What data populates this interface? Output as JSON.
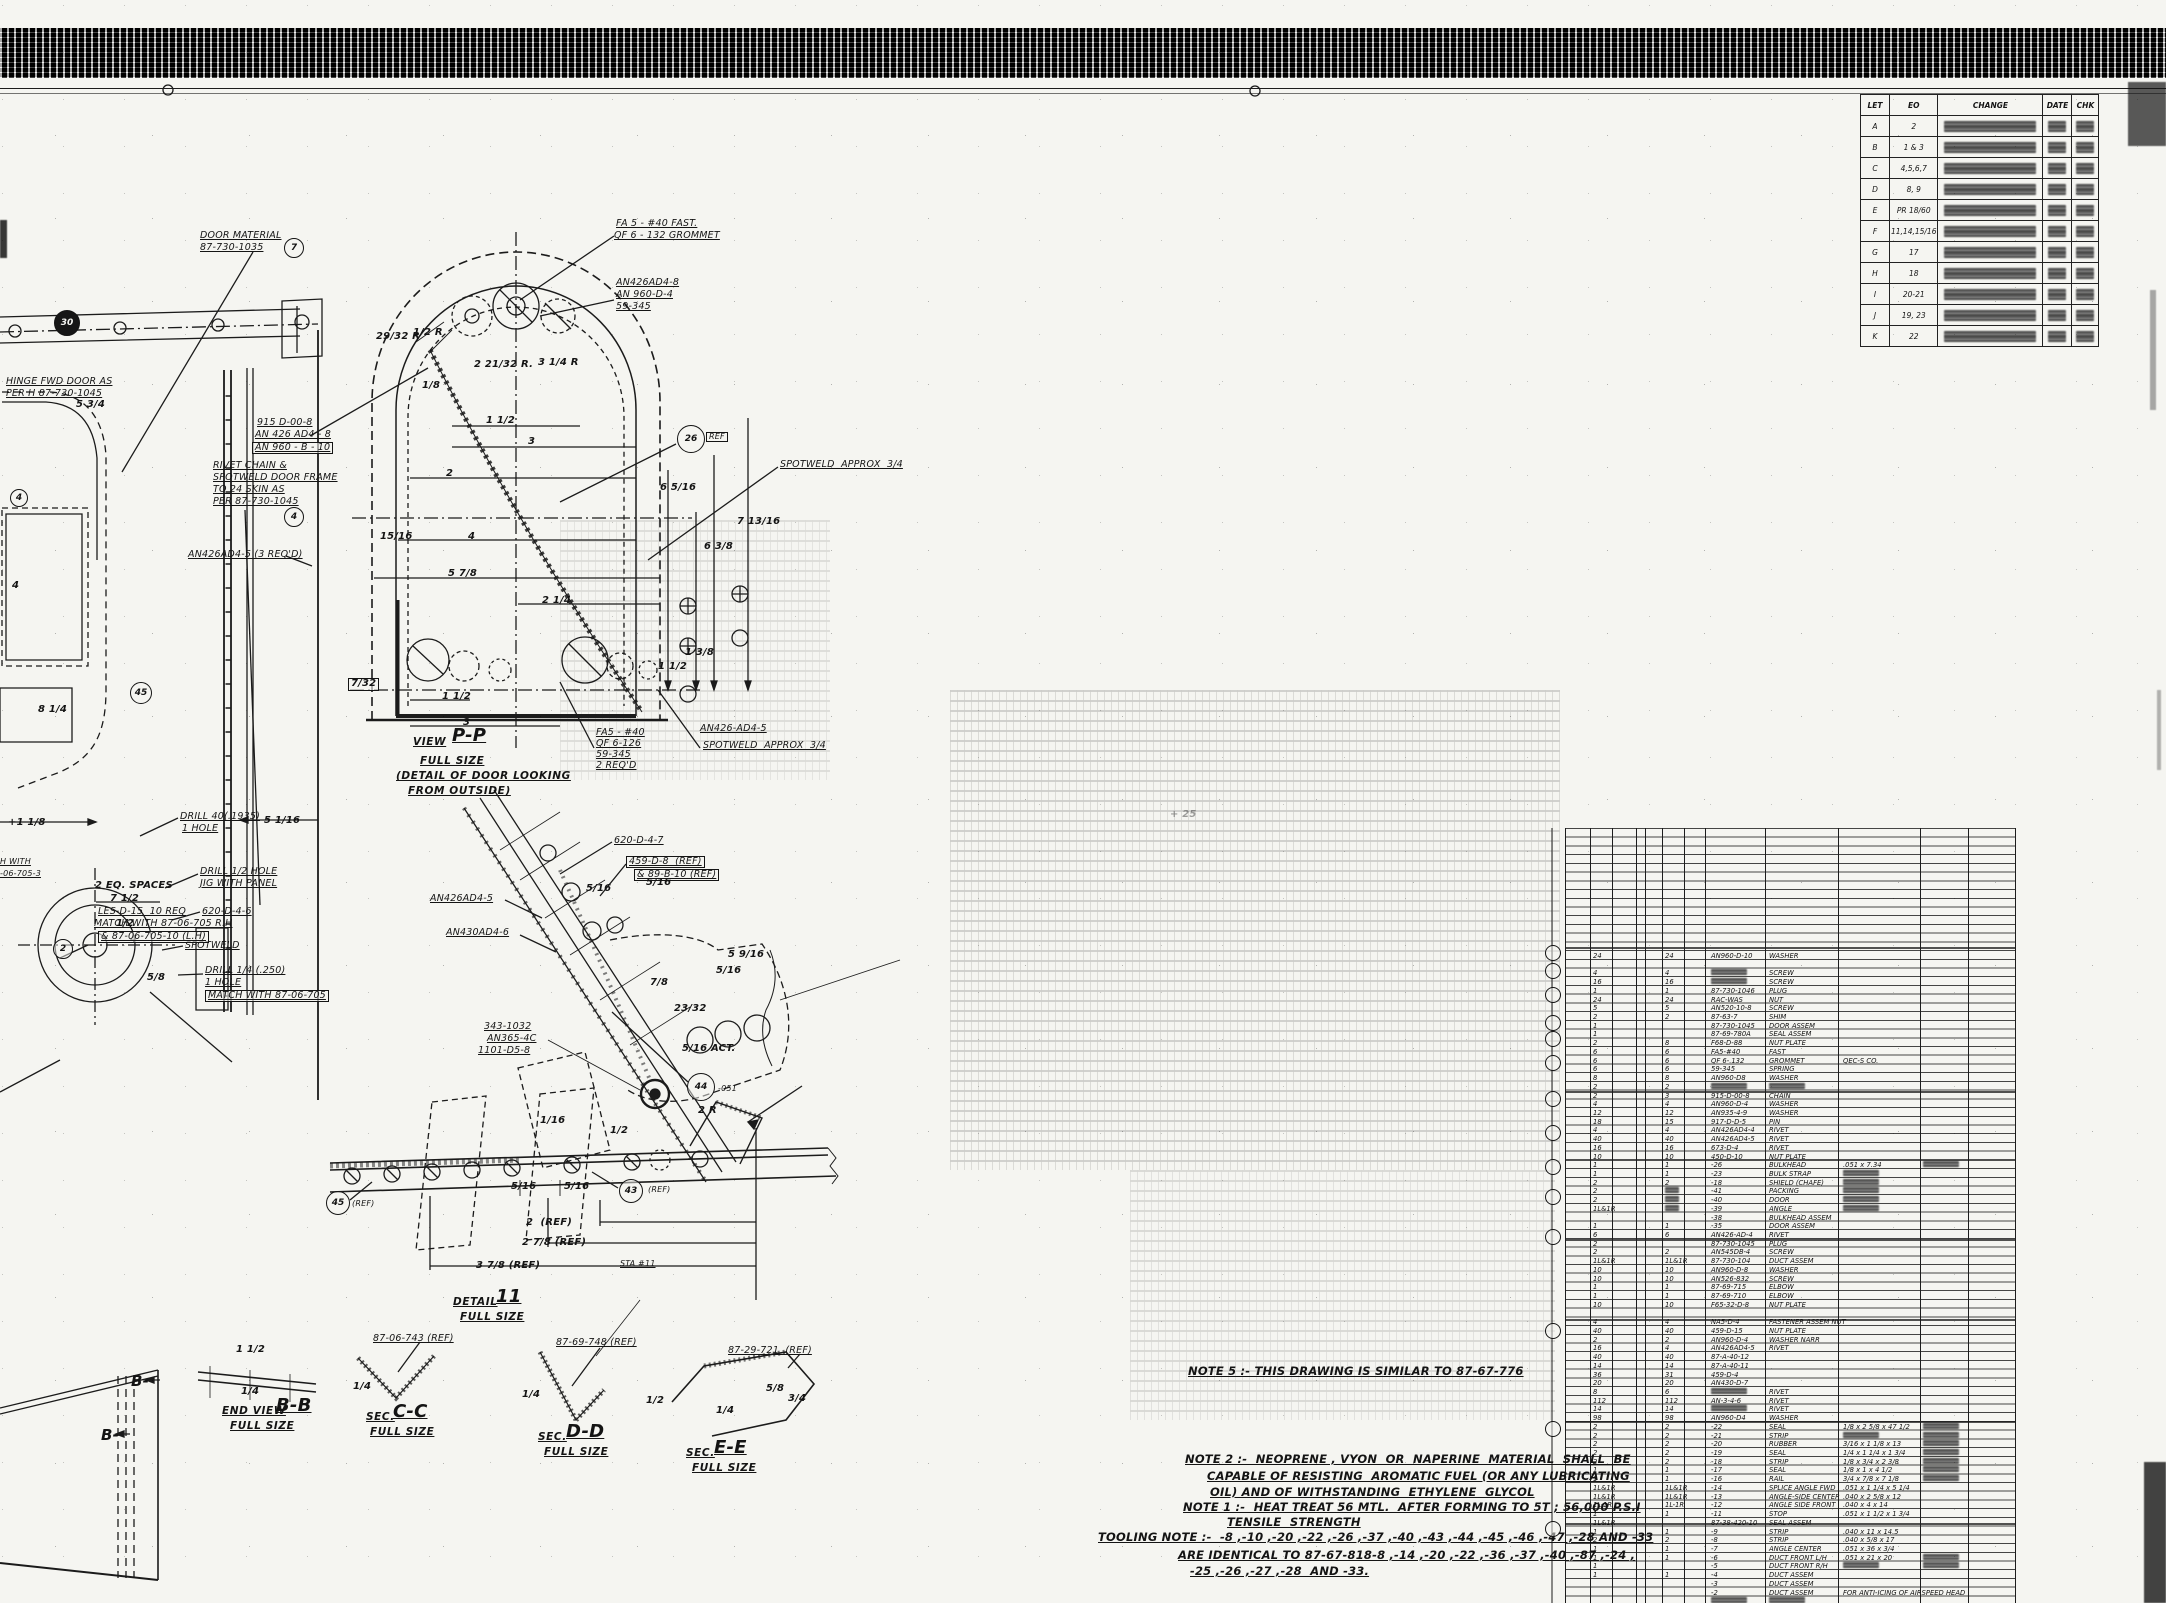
{
  "sheet": {
    "kind": "scanned engineering drawing"
  },
  "revision": {
    "headers": [
      "LET",
      "EO",
      "CHANGE",
      "DATE",
      "CHK"
    ],
    "rows": [
      {
        "let": "A",
        "eo": "2"
      },
      {
        "let": "B",
        "eo": "1 & 3"
      },
      {
        "let": "C",
        "eo": "4,5,6,7"
      },
      {
        "let": "D",
        "eo": "8, 9"
      },
      {
        "let": "E",
        "eo": "PR 18/60"
      },
      {
        "let": "F",
        "eo": "11,14,15/16"
      },
      {
        "let": "G",
        "eo": "17"
      },
      {
        "let": "H",
        "eo": "18"
      },
      {
        "let": "I",
        "eo": "20-21"
      },
      {
        "let": "J",
        "eo": "19, 23"
      },
      {
        "let": "K",
        "eo": "22"
      }
    ]
  },
  "notes": {
    "note5": "NOTE 5 :- THIS DRAWING IS SIMILAR TO 87-67-776",
    "note2_l1": "NOTE 2 :-  NEOPRENE , VYON  OR  NAPERINE  MATERIAL  SHALL  BE",
    "note2_l2": "CAPABLE OF RESISTING  AROMATIC FUEL (OR ANY LUBRICATING",
    "note2_l3": "OIL) AND OF WITHSTANDING  ETHYLENE  GLYCOL",
    "note1_l1": "NOTE 1 :-  HEAT TREAT 56 MTL.  AFTER FORMING TO 5T ; 56,000 P.S.I",
    "note1_l2": "TENSILE  STRENGTH",
    "tooling_l1": "TOOLING NOTE :-  -8 ,-10 ,-20 ,-22 ,-26 ,-37 ,-40 ,-43 ,-44 ,-45 ,-46 ,-47 ,-28 AND -33",
    "tooling_l2": "ARE IDENTICAL TO 87-67-818-8 ,-14 ,-20 ,-22 ,-36 ,-37 ,-40 ,-87 ,-24 ,",
    "tooling_l3": "-25 ,-26 ,-27 ,-28  AND -33."
  },
  "annotations": [
    [
      200,
      231,
      "DOOR MATERIAL",
      "u"
    ],
    [
      200,
      243,
      "87-730-1035",
      "u"
    ],
    [
      6,
      377,
      "HINGE FWD DOOR AS",
      "u"
    ],
    [
      6,
      389,
      "PER H 87-730-1045",
      "u"
    ],
    [
      257,
      418,
      "915 D-00-8",
      "u"
    ],
    [
      255,
      430,
      "AN 426 AD4 - 8",
      "u"
    ],
    [
      252,
      442,
      "AN 960 - B - 10",
      "u box"
    ],
    [
      213,
      461,
      "RIVET CHAIN &",
      "u"
    ],
    [
      213,
      473,
      "SPOTWELD DOOR FRAME",
      "u"
    ],
    [
      213,
      485,
      "TO 24 SKIN AS",
      "u"
    ],
    [
      213,
      497,
      "PER 87-730-1045",
      "u"
    ],
    [
      188,
      550,
      "AN426AD4-5 (3 REQ'D)",
      "u"
    ],
    [
      76,
      400,
      "5 3/4",
      "d"
    ],
    [
      12,
      581,
      "4",
      "d"
    ],
    [
      38,
      705,
      "8 1/4",
      "d"
    ],
    [
      8,
      818,
      "+1 1/8",
      "d"
    ],
    [
      264,
      816,
      "5 1/16",
      "d"
    ],
    [
      116,
      919,
      "1/2",
      "d"
    ],
    [
      130,
      935,
      "4",
      "d"
    ],
    [
      147,
      973,
      "5/8",
      "d"
    ],
    [
      180,
      812,
      "DRILL 40(.1935)",
      "u"
    ],
    [
      182,
      824,
      "1 HOLE",
      "u"
    ],
    [
      200,
      867,
      "DRILL 1/2 HOLE",
      "u"
    ],
    [
      200,
      879,
      "JIG WITH PANEL",
      "u"
    ],
    [
      202,
      907,
      "620-D-4-6",
      "u"
    ],
    [
      185,
      941,
      "SPOTWELD",
      "u"
    ],
    [
      205,
      966,
      "DRILL 1/4 (.250)",
      "u"
    ],
    [
      205,
      978,
      "1 HOLE",
      "u"
    ],
    [
      205,
      990,
      "MATCH WITH 87-06-705",
      "u box"
    ],
    [
      95,
      881,
      "2 EQ. SPACES",
      "d"
    ],
    [
      110,
      894,
      "7 1/2",
      "d"
    ],
    [
      98,
      907,
      "LES-D-15  10 REQ",
      "u"
    ],
    [
      94,
      919,
      "MATCH WITH 87-06-705 R.H",
      "u"
    ],
    [
      98,
      931,
      "& 87-06-705-10 (L.H)",
      "u box"
    ],
    [
      0,
      858,
      "H WITH",
      "s u"
    ],
    [
      0,
      870,
      "-06-705-3",
      "s u"
    ],
    [
      616,
      219,
      "FA 5 - #40 FAST.",
      "u"
    ],
    [
      614,
      231,
      "QF 6 - 132 GROMMET",
      "u"
    ],
    [
      616,
      278,
      "AN426AD4-8",
      "u"
    ],
    [
      616,
      290,
      "AN 960-D-4",
      "u"
    ],
    [
      616,
      302,
      "59-345",
      "u"
    ],
    [
      376,
      332,
      "29/32 R",
      "d"
    ],
    [
      413,
      328,
      "1/2 R",
      "d"
    ],
    [
      474,
      360,
      "2 21/32 R.",
      "d"
    ],
    [
      538,
      358,
      "3 1/4 R",
      "d"
    ],
    [
      422,
      381,
      "1/8",
      "d"
    ],
    [
      486,
      416,
      "1 1/2",
      "d"
    ],
    [
      528,
      437,
      "3",
      "d"
    ],
    [
      446,
      469,
      "2",
      "d"
    ],
    [
      468,
      532,
      "4",
      "d"
    ],
    [
      380,
      532,
      "15/16",
      "d"
    ],
    [
      448,
      569,
      "5 7/8",
      "d"
    ],
    [
      542,
      596,
      "2 1/4",
      "d"
    ],
    [
      348,
      678,
      "7/32",
      "d box"
    ],
    [
      660,
      483,
      "6 5/16",
      "d"
    ],
    [
      704,
      542,
      "6 3/8",
      "d"
    ],
    [
      737,
      517,
      "7 13/16",
      "d"
    ],
    [
      658,
      662,
      "1 1/2",
      "d"
    ],
    [
      685,
      648,
      "1 3/8",
      "d"
    ],
    [
      780,
      460,
      "SPOTWELD  APPROX  3/4",
      "u"
    ],
    [
      706,
      432,
      "REF",
      "s box"
    ],
    [
      442,
      692,
      "1 1/2",
      "d"
    ],
    [
      463,
      718,
      "3",
      "d"
    ],
    [
      596,
      728,
      "FA5 - #40",
      "u"
    ],
    [
      596,
      739,
      "QF 6-126",
      "u"
    ],
    [
      596,
      750,
      "59-345",
      "u"
    ],
    [
      596,
      761,
      "2 REQ'D",
      "u"
    ],
    [
      700,
      724,
      "AN426-AD4-5",
      "u"
    ],
    [
      703,
      741,
      "SPOTWELD  APPROX  3/4",
      "u"
    ],
    [
      413,
      737,
      "VIEW",
      "t2"
    ],
    [
      452,
      727,
      "P-P",
      "t1"
    ],
    [
      420,
      756,
      "FULL SIZE",
      "t2"
    ],
    [
      396,
      771,
      "(DETAIL OF DOOR LOOKING",
      "t2"
    ],
    [
      408,
      786,
      "FROM OUTSIDE)",
      "t2"
    ],
    [
      614,
      836,
      "620-D-4-7",
      "u"
    ],
    [
      626,
      856,
      "459-D-8  (REF)",
      "u box"
    ],
    [
      634,
      869,
      "& 89-B-10 (REF)",
      "u box"
    ],
    [
      430,
      894,
      "AN426AD4-5",
      "u"
    ],
    [
      446,
      928,
      "AN430AD4-6",
      "u"
    ],
    [
      586,
      884,
      "5/16",
      "d"
    ],
    [
      646,
      878,
      "5/16",
      "d"
    ],
    [
      728,
      950,
      "5 9/16",
      "d"
    ],
    [
      716,
      966,
      "5/16",
      "d"
    ],
    [
      650,
      978,
      "7/8",
      "d"
    ],
    [
      674,
      1004,
      "23/32",
      "d"
    ],
    [
      682,
      1044,
      "5/16 ACT.",
      "d"
    ],
    [
      484,
      1022,
      "343-1032",
      "u"
    ],
    [
      487,
      1034,
      "AN365-4C",
      "u"
    ],
    [
      478,
      1046,
      "1101-D5-8",
      "u"
    ],
    [
      718,
      1085,
      "-051",
      "s"
    ],
    [
      540,
      1116,
      "1/16",
      "d"
    ],
    [
      511,
      1182,
      "5/16",
      "d"
    ],
    [
      564,
      1182,
      "5/16",
      "d"
    ],
    [
      648,
      1186,
      "(REF)",
      "s"
    ],
    [
      352,
      1200,
      "(REF)",
      "s"
    ],
    [
      526,
      1218,
      "2  (REF)",
      "d"
    ],
    [
      522,
      1238,
      "2 7/8 (REF)",
      "d"
    ],
    [
      476,
      1261,
      "3 7/8 (REF)",
      "d"
    ],
    [
      620,
      1260,
      "STA #11",
      "s u"
    ],
    [
      453,
      1297,
      "DETAIL",
      "t2"
    ],
    [
      496,
      1288,
      "11",
      "t1"
    ],
    [
      460,
      1312,
      "FULL SIZE",
      "t2"
    ],
    [
      373,
      1334,
      "87-06-743 (REF)",
      "u"
    ],
    [
      556,
      1338,
      "87-69-748 (REF)",
      "u"
    ],
    [
      728,
      1346,
      "87-29-721  (REF)",
      "u"
    ],
    [
      131,
      1374,
      "B-",
      "t3"
    ],
    [
      101,
      1428,
      "B-",
      "t3"
    ],
    [
      236,
      1345,
      "1 1/2",
      "d"
    ],
    [
      241,
      1387,
      "1/4",
      "d"
    ],
    [
      222,
      1406,
      "END VIEW",
      "t2"
    ],
    [
      276,
      1397,
      "B-B",
      "t1"
    ],
    [
      230,
      1421,
      "FULL SIZE",
      "t2"
    ],
    [
      353,
      1382,
      "1/4",
      "d"
    ],
    [
      366,
      1412,
      "SEC.",
      "t2"
    ],
    [
      393,
      1403,
      "C-C",
      "t1"
    ],
    [
      370,
      1427,
      "FULL SIZE",
      "t2"
    ],
    [
      522,
      1390,
      "1/4",
      "d"
    ],
    [
      538,
      1432,
      "SEC.",
      "t2"
    ],
    [
      566,
      1423,
      "D-D",
      "t1"
    ],
    [
      544,
      1447,
      "FULL SIZE",
      "t2"
    ],
    [
      686,
      1448,
      "SEC.",
      "t2"
    ],
    [
      714,
      1439,
      "E-E",
      "t1"
    ],
    [
      692,
      1463,
      "FULL SIZE",
      "t2"
    ],
    [
      766,
      1384,
      "5/8",
      "d"
    ],
    [
      788,
      1394,
      "3/4",
      "d"
    ],
    [
      716,
      1406,
      "1/4",
      "d"
    ],
    [
      646,
      1396,
      "1/2",
      "d"
    ],
    [
      610,
      1126,
      "1/2",
      "d"
    ],
    [
      698,
      1106,
      "2 R",
      "d"
    ],
    [
      1170,
      810,
      "+ 25",
      "f d"
    ]
  ],
  "balloons": [
    [
      690,
      438,
      "26",
      13
    ],
    [
      293,
      247,
      "7",
      9
    ],
    [
      293,
      516,
      "4",
      9
    ],
    [
      62,
      948,
      "2",
      9
    ],
    [
      140,
      692,
      "45",
      10
    ],
    [
      18,
      497,
      "4",
      8
    ],
    [
      700,
      1086,
      "44",
      13
    ],
    [
      630,
      1190,
      "43",
      11
    ],
    [
      337,
      1202,
      "45",
      11
    ],
    [
      66,
      322,
      "30",
      12,
      "filled"
    ],
    [
      1552,
      952,
      "",
      7
    ],
    [
      1552,
      970,
      "",
      7
    ],
    [
      1552,
      994,
      "",
      7
    ],
    [
      1552,
      1022,
      "",
      7
    ],
    [
      1552,
      1038,
      "",
      7
    ],
    [
      1552,
      1062,
      "",
      7
    ],
    [
      1552,
      1098,
      "",
      7
    ],
    [
      1552,
      1132,
      "",
      7
    ],
    [
      1552,
      1166,
      "",
      7
    ],
    [
      1552,
      1196,
      "",
      7
    ],
    [
      1552,
      1236,
      "",
      7
    ],
    [
      1552,
      1330,
      "",
      7
    ],
    [
      1552,
      1428,
      "",
      7
    ],
    [
      1552,
      1528,
      "",
      7
    ]
  ],
  "parts": {
    "first_y": 952,
    "row_h": 8.72,
    "columns": {
      "q1": 28,
      "q2": 100,
      "part": 146,
      "desc": 204,
      "mat": 278,
      "note": 358
    },
    "rows": [
      [
        "24",
        "24",
        "AN960-D-10",
        "WASHER",
        "",
        ""
      ],
      [
        "",
        "",
        "",
        "",
        "",
        ""
      ],
      [
        "4",
        "4",
        "~",
        "SCREW",
        "",
        ""
      ],
      [
        "16",
        "16",
        "~",
        "SCREW",
        "",
        ""
      ],
      [
        "1",
        "1",
        "87-730-1046",
        "PLUG",
        "",
        ""
      ],
      [
        "24",
        "24",
        "RAC-WAS",
        "NUT",
        "",
        ""
      ],
      [
        "5",
        "5",
        "AN520-10-8",
        "SCREW",
        "",
        ""
      ],
      [
        "2",
        "2",
        "87-63-7",
        "SHIM",
        "",
        ""
      ],
      [
        "1",
        "",
        "87-730-1045",
        "DOOR ASSEM",
        "",
        ""
      ],
      [
        "1",
        "",
        "87-69-780A",
        "SEAL ASSEM",
        "",
        ""
      ],
      [
        "2",
        "8",
        "F68-D-88",
        "NUT PLATE",
        "",
        ""
      ],
      [
        "6",
        "6",
        "FA5-#40",
        "FAST",
        "",
        ""
      ],
      [
        "6",
        "6",
        "QF 6-.132",
        "GROMMET",
        "QEC-S CO.",
        ""
      ],
      [
        "6",
        "6",
        "59-345",
        "SPRING",
        "",
        ""
      ],
      [
        "8",
        "8",
        "AN960-D8",
        "WASHER",
        "",
        ""
      ],
      [
        "2",
        "2",
        "~",
        "~",
        "",
        ""
      ],
      [
        "2",
        "3",
        "915-D-00-8",
        "CHAIN",
        "",
        ""
      ],
      [
        "4",
        "4",
        "AN960-D-4",
        "WASHER",
        "",
        ""
      ],
      [
        "12",
        "12",
        "AN935-4-9",
        "WASHER",
        "",
        ""
      ],
      [
        "18",
        "15",
        "917-D-D-5",
        "PIN",
        "",
        ""
      ],
      [
        "4",
        "4",
        "AN426AD4-4",
        "RIVET",
        "",
        ""
      ],
      [
        "40",
        "40",
        "AN426AD4-5",
        "RIVET",
        "",
        ""
      ],
      [
        "16",
        "16",
        "673-D-4",
        "RIVET",
        "",
        ""
      ],
      [
        "10",
        "10",
        "450-D-10",
        "NUT PLATE",
        "",
        ""
      ],
      [
        "1",
        "1",
        "-26",
        "BULKHEAD",
        ".051 x 7.34",
        "~"
      ],
      [
        "1",
        "1",
        "-23",
        "BULK STRAP",
        "~",
        ""
      ],
      [
        "2",
        "2",
        "-18",
        "SHIELD (CHAFE)",
        "~",
        ""
      ],
      [
        "2",
        "~",
        "-41",
        "PACKING",
        "~",
        ""
      ],
      [
        "2",
        "~",
        "-40",
        "DOOR",
        "~",
        ""
      ],
      [
        "1L&1R",
        "~",
        "-39",
        "ANGLE",
        "~",
        ""
      ],
      [
        "",
        "",
        "-38",
        "BULKHEAD ASSEM",
        "",
        ""
      ],
      [
        "1",
        "1",
        "-35",
        "DOOR ASSEM",
        "",
        ""
      ],
      [
        "6",
        "6",
        "AN426-AD-4",
        "RIVET",
        "",
        ""
      ],
      [
        "2",
        "",
        "87-730-1045",
        "PLUG",
        "",
        ""
      ],
      [
        "2",
        "2",
        "AN545DB-4",
        "SCREW",
        "",
        ""
      ],
      [
        "1L&1R",
        "1L&1R",
        "87-730-104",
        "DUCT ASSEM",
        "",
        ""
      ],
      [
        "10",
        "10",
        "AN960-D-8",
        "WASHER",
        "",
        ""
      ],
      [
        "10",
        "10",
        "AN526-832",
        "SCREW",
        "",
        ""
      ],
      [
        "1",
        "1",
        "87-69-715",
        "ELBOW",
        "",
        ""
      ],
      [
        "1",
        "1",
        "87-69-710",
        "ELBOW",
        "",
        ""
      ],
      [
        "10",
        "10",
        "F65-32-D-8",
        "NUT PLATE",
        "",
        ""
      ],
      [
        "",
        "",
        "",
        "",
        "",
        ""
      ],
      [
        "4",
        "4",
        "NA5-D-4",
        "FASTENER ASSEM NUT",
        "",
        ""
      ],
      [
        "40",
        "40",
        "459-D-15",
        "NUT PLATE",
        "",
        ""
      ],
      [
        "2",
        "2",
        "AN960-D-4",
        "WASHER NARR",
        "",
        ""
      ],
      [
        "16",
        "4",
        "AN426AD4-5",
        "RIVET",
        "",
        ""
      ],
      [
        "40",
        "40",
        "87-A-40-12",
        "",
        "",
        ""
      ],
      [
        "14",
        "14",
        "87-A-40-11",
        "",
        "",
        ""
      ],
      [
        "36",
        "31",
        "459-D-4",
        "",
        "",
        ""
      ],
      [
        "20",
        "20",
        "AN430-D-7",
        "",
        "",
        ""
      ],
      [
        "8",
        "6",
        "~",
        "RIVET",
        "",
        ""
      ],
      [
        "112",
        "112",
        "AN-3-4-6",
        "RIVET",
        "",
        ""
      ],
      [
        "14",
        "14",
        "~",
        "RIVET",
        "",
        ""
      ],
      [
        "98",
        "98",
        "AN960-D4",
        "WASHER",
        "",
        ""
      ],
      [
        "2",
        "2",
        "-22",
        "SEAL",
        "1/8 x 2 5/8 x 47 1/2",
        "~"
      ],
      [
        "2",
        "2",
        "-21",
        "STRIP",
        "~",
        "~"
      ],
      [
        "2",
        "2",
        "-20",
        "RUBBER",
        "3/16 x 1 1/8 x 13",
        "~"
      ],
      [
        "2",
        "2",
        "-19",
        "SEAL",
        "1/4 x 1 1/4 x 1 3/4",
        "~"
      ],
      [
        "2",
        "2",
        "-18",
        "STRIP",
        "1/8 x 3/4 x 2 3/8",
        "~"
      ],
      [
        "1",
        "1",
        "-17",
        "SEAL",
        "1/8 x 1 x 4 1/2",
        "~"
      ],
      [
        "1",
        "1",
        "-16",
        "RAIL",
        "3/4 x 7/8 x 7 1/8",
        "~"
      ],
      [
        "1L&1R",
        "1L&1R",
        "-14",
        "SPLICE ANGLE FWD",
        ".051 x 1 1/4 x 5 1/4",
        ""
      ],
      [
        "1L&1R",
        "1L&1R",
        "-13",
        "ANGLE-SIDE CENTER",
        ".040 x 2 5/8 x 12",
        ""
      ],
      [
        "1L-1R",
        "1L-1R",
        "-12",
        "ANGLE SIDE FRONT",
        ".040 x 4 x 14",
        ""
      ],
      [
        "1",
        "1",
        "-11",
        "STOP",
        ".051 x 1 1/2 x 1 3/4",
        ""
      ],
      [
        "1L&1R",
        "",
        "87-38-420-10",
        "SEAL ASSEM",
        "",
        ""
      ],
      [
        "1",
        "1",
        "-9",
        "STRIP",
        ".040 x 11 x 14.5",
        ""
      ],
      [
        "2",
        "2",
        "-8",
        "STRIP",
        ".040 x 5/8 x 17",
        ""
      ],
      [
        "1",
        "1",
        "-7",
        "ANGLE CENTER",
        ".051 x 36 x 3/4",
        ""
      ],
      [
        "1",
        "1",
        "-6",
        "DUCT FRONT L/H",
        ".051 x 21 x 20",
        "~"
      ],
      [
        "1",
        "",
        "-5",
        "DUCT FRONT R/H",
        "~",
        "~"
      ],
      [
        "1",
        "1",
        "-4",
        "DUCT ASSEM",
        "",
        ""
      ],
      [
        "",
        "",
        "-3",
        "DUCT ASSEM",
        "",
        ""
      ],
      [
        "",
        "",
        "-2",
        "DUCT ASSEM",
        "FOR ANTI-ICING OF AIRSPEED HEAD",
        ""
      ],
      [
        "",
        "",
        "~",
        "~",
        "",
        ""
      ]
    ]
  }
}
